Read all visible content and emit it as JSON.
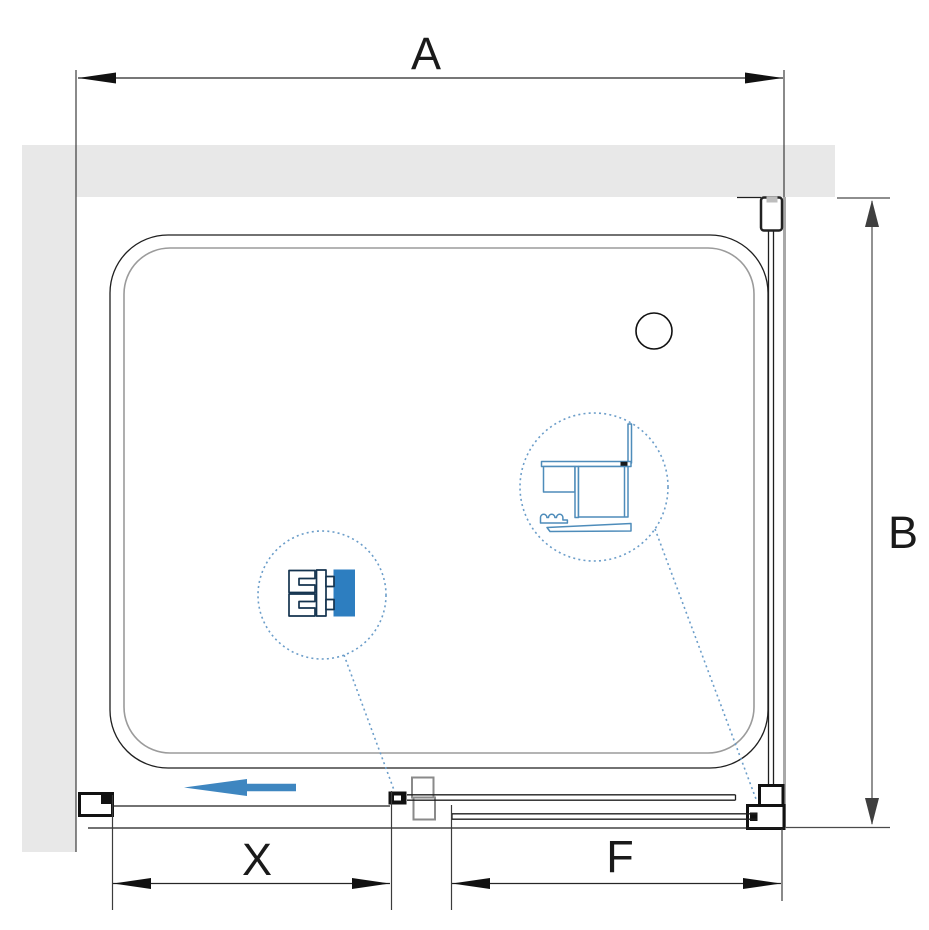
{
  "diagram": {
    "type": "shower-enclosure-top-view-technical-drawing",
    "dimensions": {
      "width_label": "A",
      "depth_label": "B",
      "door_opening_label": "X",
      "fixed_panel_label": "F"
    },
    "colors": {
      "slide_arrow_blue": "#3E86C0",
      "glass_fill_blue": "#2D7EC0",
      "leader_dotted_blue": "#6B9DC9",
      "profile_stroke_blue": "#4E8CBA",
      "profile_stroke_navy": "#14334F",
      "wall_gray": "#E8E8E8",
      "tray_inner_gray": "#9B9B9B",
      "line_black": "#1A1A1A"
    }
  }
}
